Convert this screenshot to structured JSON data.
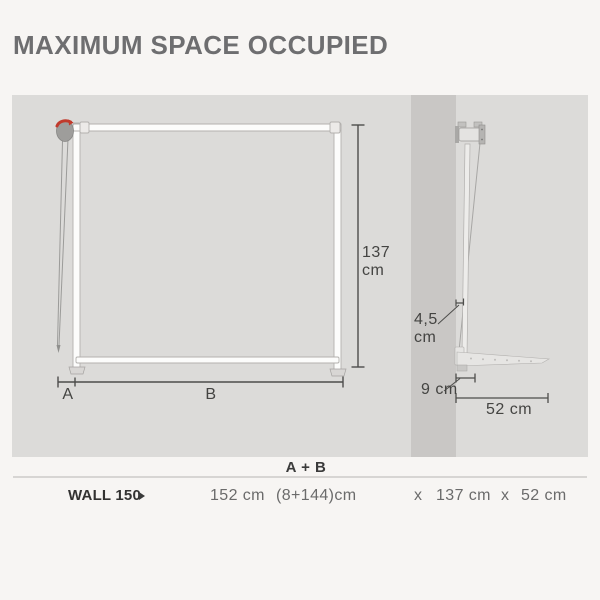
{
  "title": "MAXIMUM SPACE OCCUPIED",
  "front_view": {
    "height": {
      "value": "137",
      "unit": "cm"
    },
    "segment_a": "A",
    "segment_b": "B"
  },
  "side_view": {
    "wall_gap": {
      "value": "4,5",
      "unit": "cm"
    },
    "bracket_depth": "9 cm",
    "total_depth": "52 cm"
  },
  "table": {
    "header_formula": "A + B",
    "rows": [
      {
        "model": "WALL 150",
        "width_total": "152 cm",
        "width_breakdown": "(8+144)cm",
        "times_1": "x",
        "height": "137 cm",
        "times_2": "x",
        "depth": "52 cm"
      }
    ]
  },
  "icons": {
    "model_arrow": "right-triangle"
  },
  "colors": {
    "background": "#f7f5f3",
    "panel_gray": "#dcdbd9",
    "wall_gray": "#c9c7c5",
    "frame_white": "#fcfcfb",
    "accent_red": "#c13a2c",
    "dimension_line": "#4d4d4b",
    "title_gray": "#6e6e70",
    "text_dark": "#3b3b3b",
    "text_gray": "#6b6b6b"
  }
}
